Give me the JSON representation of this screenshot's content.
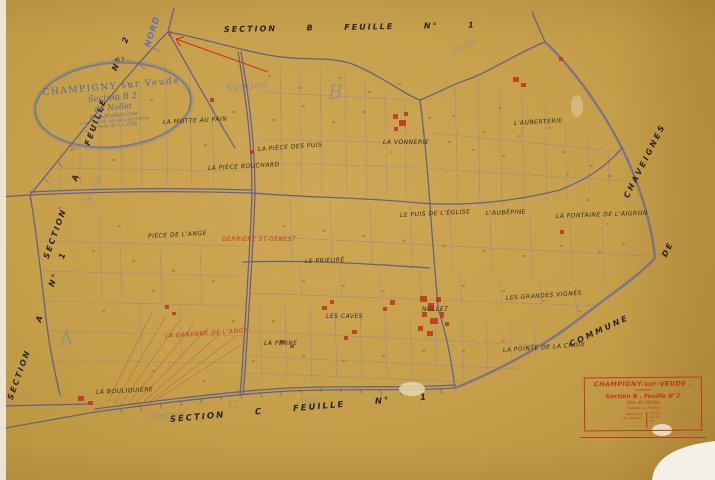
{
  "palette": {
    "paper": "#c7a04c",
    "ink_purple": "#56568e",
    "ink_red": "#bf3220",
    "ink_black": "#2b261c",
    "ink_blue": "#5d74b5",
    "faint_blue": "#627CBE"
  },
  "margin_labels": {
    "top": "SECTION  B  FEUILLE  N°  1",
    "bottom": "SECTION  C  FEUILLE  N°  1",
    "left_upper": "SECTION  A  FEUILLE  N° 2",
    "left_lower": "SECTION  A  N° 1",
    "right_top": "CHAVEIGNES",
    "right_mid": "DE",
    "right_bottom": "COMMUNE",
    "north": "NORD",
    "page_number": "- 57 -",
    "red_mark": "2"
  },
  "stamp": {
    "line1": "CHAMPIGNY sur Veude",
    "line2": "Section B 2",
    "line3": "du Nollet",
    "line4": "En 4 feuilles 2me",
    "line5": "Levé par M. Moreau géomètre",
    "line6": "Échelle de 1 à 2500"
  },
  "cartouche": {
    "title": "CHAMPIGNY-sur-VEUDE .",
    "small": "cadastrée",
    "line2": "Section B . Feuille N°2",
    "line3": "dite du Nollet",
    "line4": "( réduite au 2500e )",
    "left_note_1": "Réduction",
    "left_note_2": "du cadastre",
    "details": [
      "levé 18—",
      "1/2500",
      "19—",
      "—"
    ],
    "footer": "— · —"
  },
  "map_labels": [
    {
      "text": "La Motte au Pain",
      "x": 163,
      "y": 119,
      "rot": -3
    },
    {
      "text": "La Pièce des Puis",
      "x": 258,
      "y": 146,
      "rot": -4
    },
    {
      "text": "La Pièce Bouchard",
      "x": 208,
      "y": 165,
      "rot": -3
    },
    {
      "text": "La Vonnerie",
      "x": 383,
      "y": 139,
      "rot": 0
    },
    {
      "text": "L'Auberterie",
      "x": 514,
      "y": 120,
      "rot": -3
    },
    {
      "text": "Le Puis de l'Église",
      "x": 400,
      "y": 212,
      "rot": -3
    },
    {
      "text": "L'Aubépine",
      "x": 486,
      "y": 210,
      "rot": -2
    },
    {
      "text": "La Fontaine de l'Aigron",
      "x": 556,
      "y": 213,
      "rot": -2
    },
    {
      "text": "Pièce de l'Ange",
      "x": 148,
      "y": 233,
      "rot": -3
    },
    {
      "text": "Derrière St-Genest",
      "x": 222,
      "y": 236,
      "rot": 0,
      "color": "#c03722"
    },
    {
      "text": "Le Prieuré",
      "x": 305,
      "y": 258,
      "rot": -2
    },
    {
      "text": "Les Grandes Vignes",
      "x": 506,
      "y": 295,
      "rot": -4
    },
    {
      "text": "Les Caves",
      "x": 326,
      "y": 313,
      "rot": 0
    },
    {
      "text": "Nollet",
      "x": 422,
      "y": 306,
      "rot": 0
    },
    {
      "text": "La Penne",
      "x": 264,
      "y": 340,
      "rot": 0
    },
    {
      "text": "La Garenne de l'Ange",
      "x": 165,
      "y": 333,
      "rot": -4,
      "color": "#c03722"
    },
    {
      "text": "La Pointe de la Croix",
      "x": 503,
      "y": 347,
      "rot": -4
    },
    {
      "text": "La Bouliquière",
      "x": 96,
      "y": 389,
      "rot": -3
    }
  ],
  "watermarks": [
    {
      "text": "Section",
      "x": 226,
      "y": 82,
      "rot": -6,
      "size": 11
    },
    {
      "text": "B",
      "x": 328,
      "y": 80,
      "rot": 0,
      "size": 20
    },
    {
      "text": "feuille",
      "x": 452,
      "y": 48,
      "rot": -25,
      "size": 9
    },
    {
      "text": "feuille",
      "x": 88,
      "y": 198,
      "rot": -65,
      "size": 9
    },
    {
      "text": "A",
      "x": 60,
      "y": 330,
      "rot": -10,
      "size": 18
    },
    {
      "text": "Section",
      "x": 150,
      "y": 412,
      "rot": -4,
      "size": 9
    },
    {
      "text": "1ère",
      "x": 300,
      "y": 396,
      "rot": -4,
      "size": 8
    },
    {
      "text": "C",
      "x": 228,
      "y": 398,
      "rot": 0,
      "size": 12,
      "color": "rgba(198,106,78,.55)"
    }
  ]
}
